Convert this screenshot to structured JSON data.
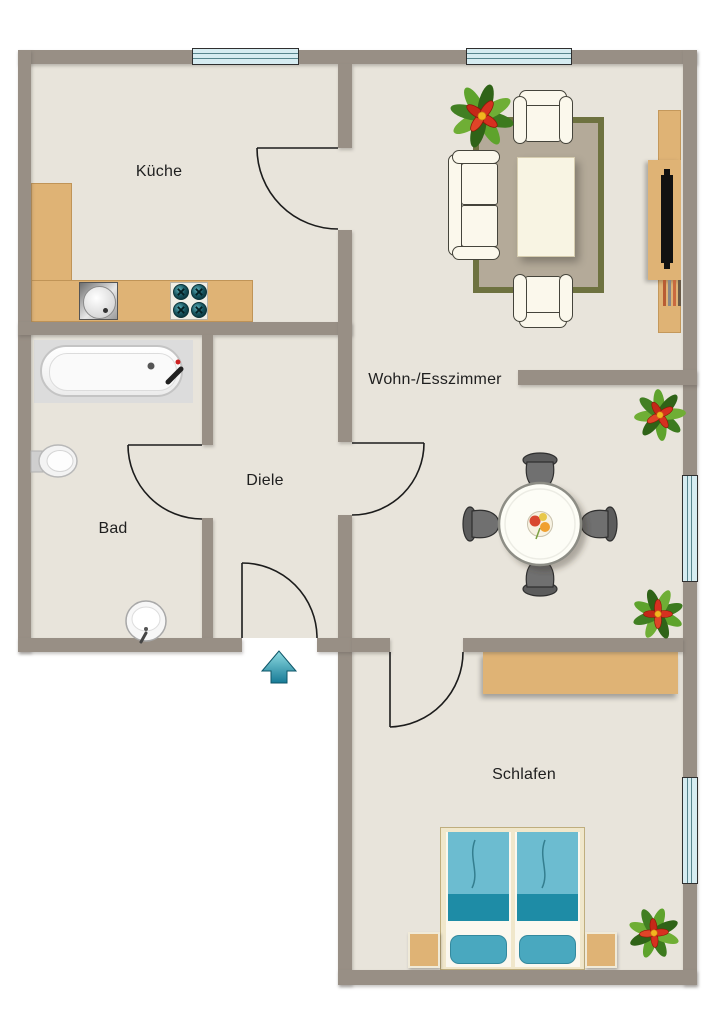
{
  "rooms": {
    "kueche": {
      "label": "Küche"
    },
    "wohn_esszimmer": {
      "label": "Wohn-/Esszimmer"
    },
    "diele": {
      "label": "Diele"
    },
    "bad": {
      "label": "Bad"
    },
    "schlafen": {
      "label": "Schlafen"
    }
  },
  "icons": {
    "entrance_arrow": "▲"
  },
  "colors": {
    "wall": "#988f85",
    "floor": "#e8e4db",
    "window_glass": "#d6ecf1",
    "window_frame": "#2f2f2f",
    "wood": "#dfb375",
    "rug_border": "#6e7240",
    "rug_fill": "#b4aa99",
    "upholstery": "#fbf8ec",
    "upholstery_line": "#45443b",
    "table_top": "#fdfdf6",
    "bed_blanket_light": "#6cbcd0",
    "bed_blanket_dark": "#1e8ca6",
    "bed_pillow": "#49a8bf",
    "bed_frame": "#f0e7cb",
    "arrow_teal": "#2a9db5",
    "door_line": "#1c1c1c",
    "label_text": "#1f1f1f"
  }
}
